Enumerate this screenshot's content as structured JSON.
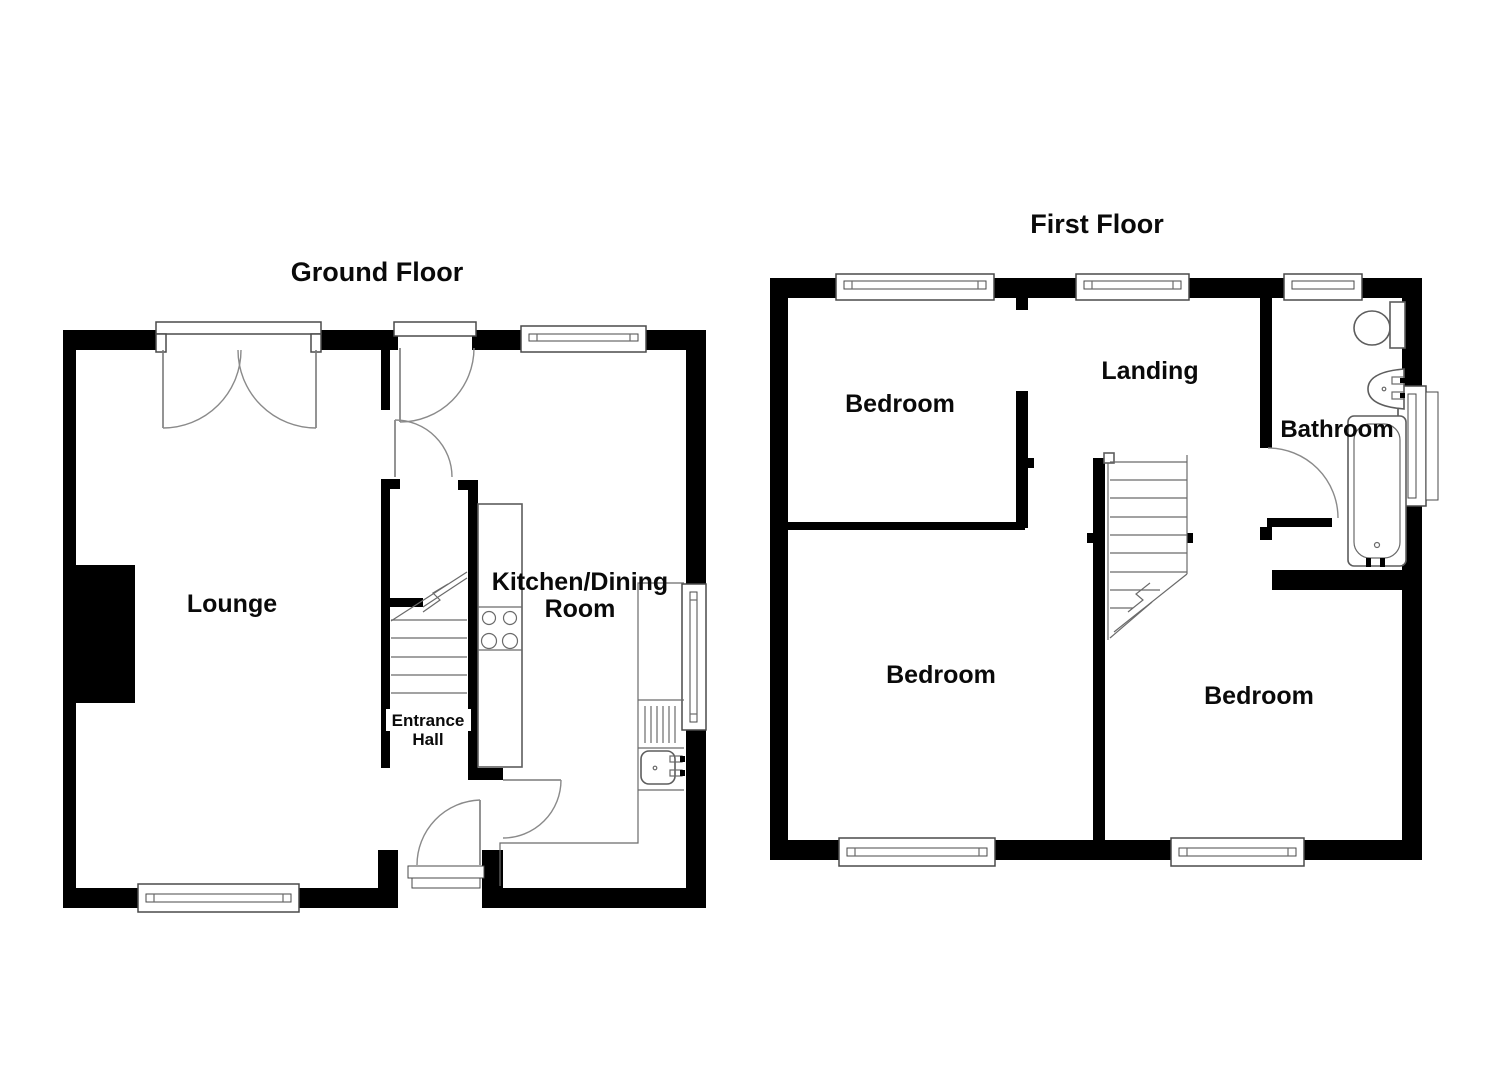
{
  "document": {
    "type": "floorplan",
    "background": "#ffffff",
    "colors": {
      "wall": "#000000",
      "fixture_line": "#5d5d5d",
      "door_arc": "#8a8a8a",
      "text": "#0a0a0a"
    }
  },
  "ground_floor": {
    "title": "Ground Floor",
    "rooms": {
      "lounge": "Lounge",
      "kitchen_line1": "Kitchen/Dining",
      "kitchen_line2": "Room",
      "hall_line1": "Entrance",
      "hall_line2": "Hall"
    }
  },
  "first_floor": {
    "title": "First Floor",
    "rooms": {
      "bedroom_nw": "Bedroom",
      "landing": "Landing",
      "bathroom": "Bathroom",
      "bedroom_sw": "Bedroom",
      "bedroom_se": "Bedroom"
    }
  }
}
